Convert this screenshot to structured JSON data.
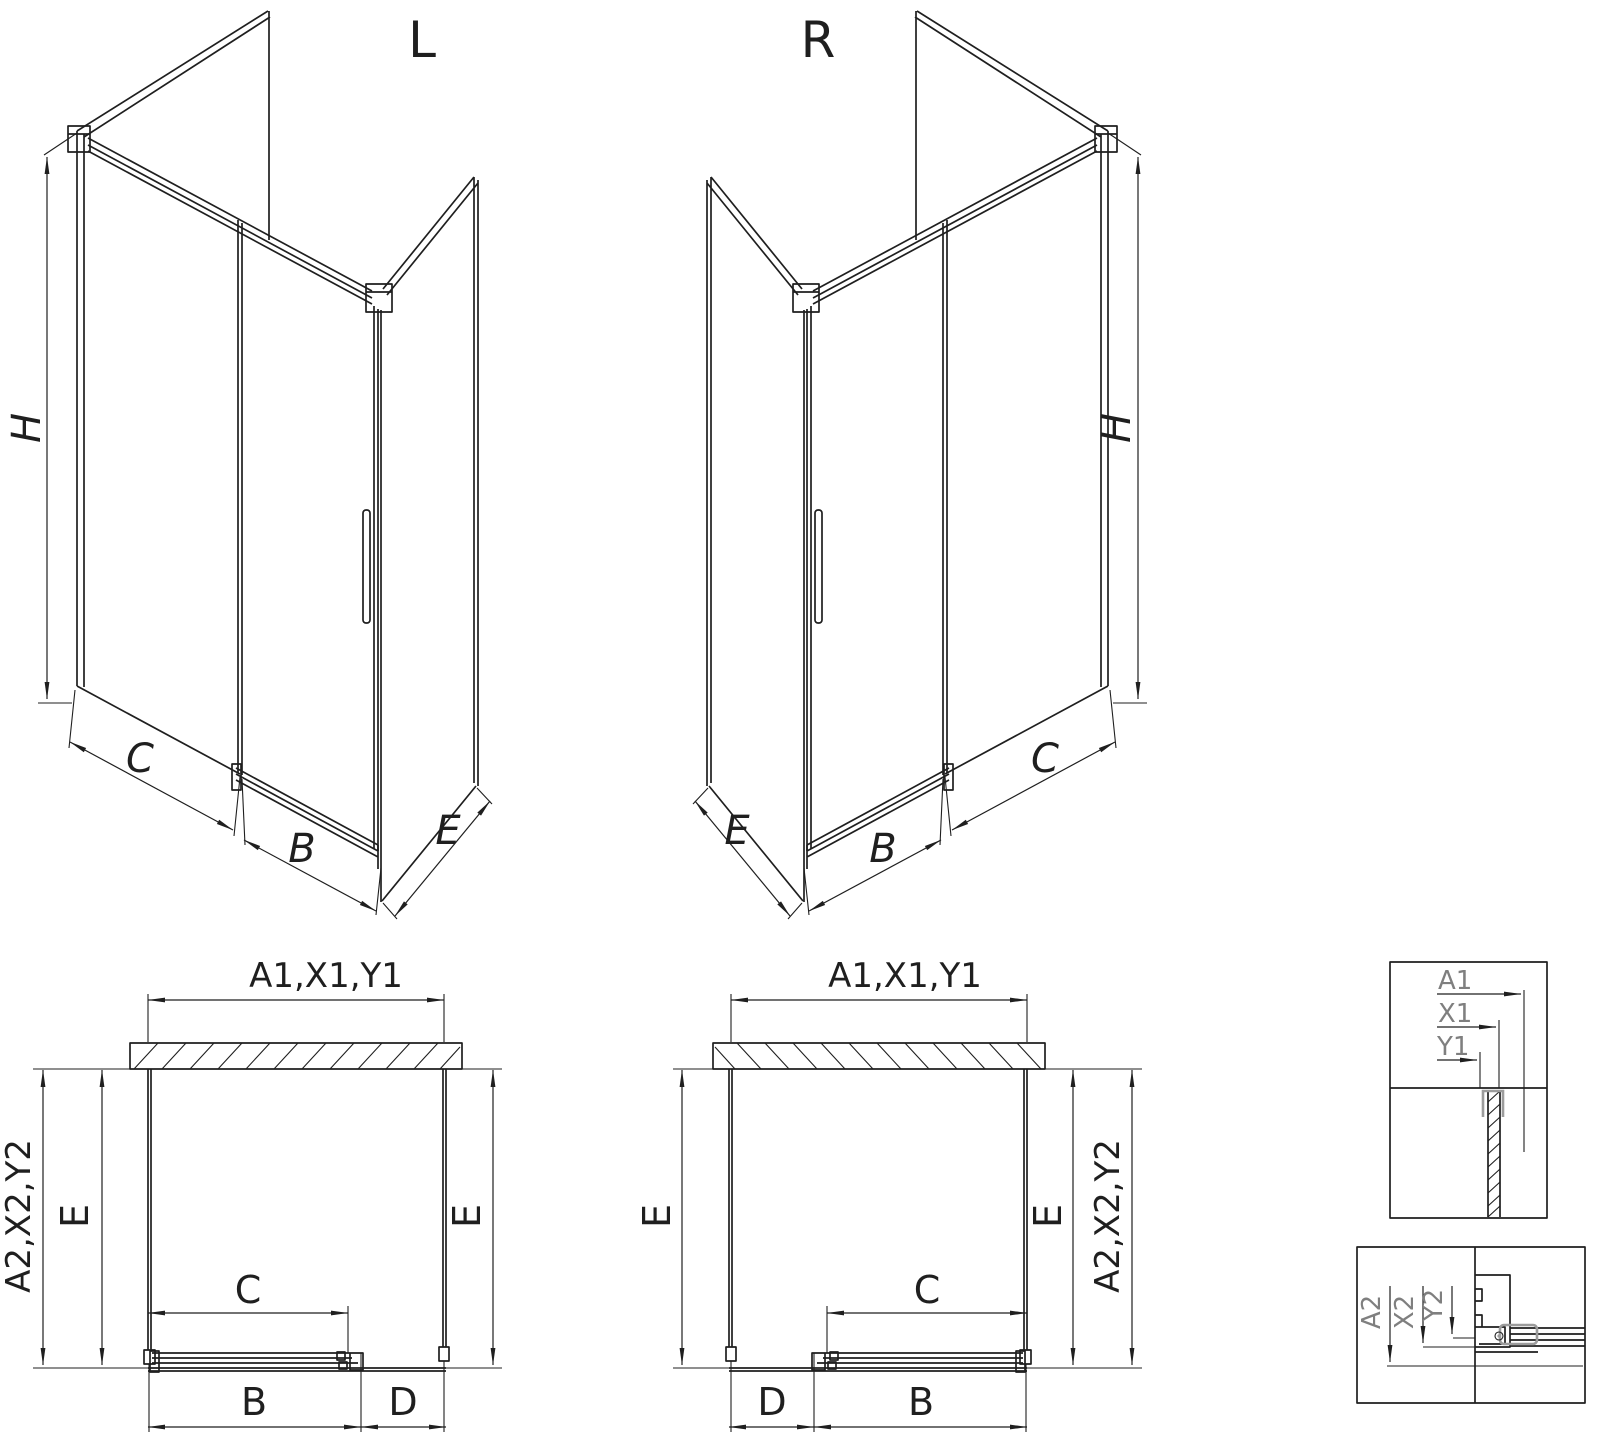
{
  "drawing": {
    "iso_left": {
      "title": "L",
      "dim_height": "H",
      "dim_fixed": "C",
      "dim_door": "B",
      "dim_side": "E"
    },
    "iso_right": {
      "title": "R",
      "dim_height": "H",
      "dim_fixed": "C",
      "dim_door": "B",
      "dim_side": "E"
    },
    "plan_left": {
      "dim_width_top": "A1,X1,Y1",
      "dim_depth_outer": "A2,X2,Y2",
      "dim_side_left": "E",
      "dim_side_right": "E",
      "dim_opening": "C",
      "dim_door": "B",
      "dim_fixed": "D"
    },
    "plan_right": {
      "dim_width_top": "A1,X1,Y1",
      "dim_depth_outer": "A2,X2,Y2",
      "dim_side_left": "E",
      "dim_side_right": "E",
      "dim_opening": "C",
      "dim_door": "B",
      "dim_fixed": "D"
    },
    "detail_top": {
      "dim_a": "A1",
      "dim_x": "X1",
      "dim_y": "Y1"
    },
    "detail_bottom": {
      "dim_a": "A2",
      "dim_x": "X2",
      "dim_y": "Y2"
    },
    "colors": {
      "line": "#1f1f1f",
      "detail_text": "#7f7f7f",
      "accent_gray": "#9c9c9c",
      "background": "#ffffff"
    }
  }
}
